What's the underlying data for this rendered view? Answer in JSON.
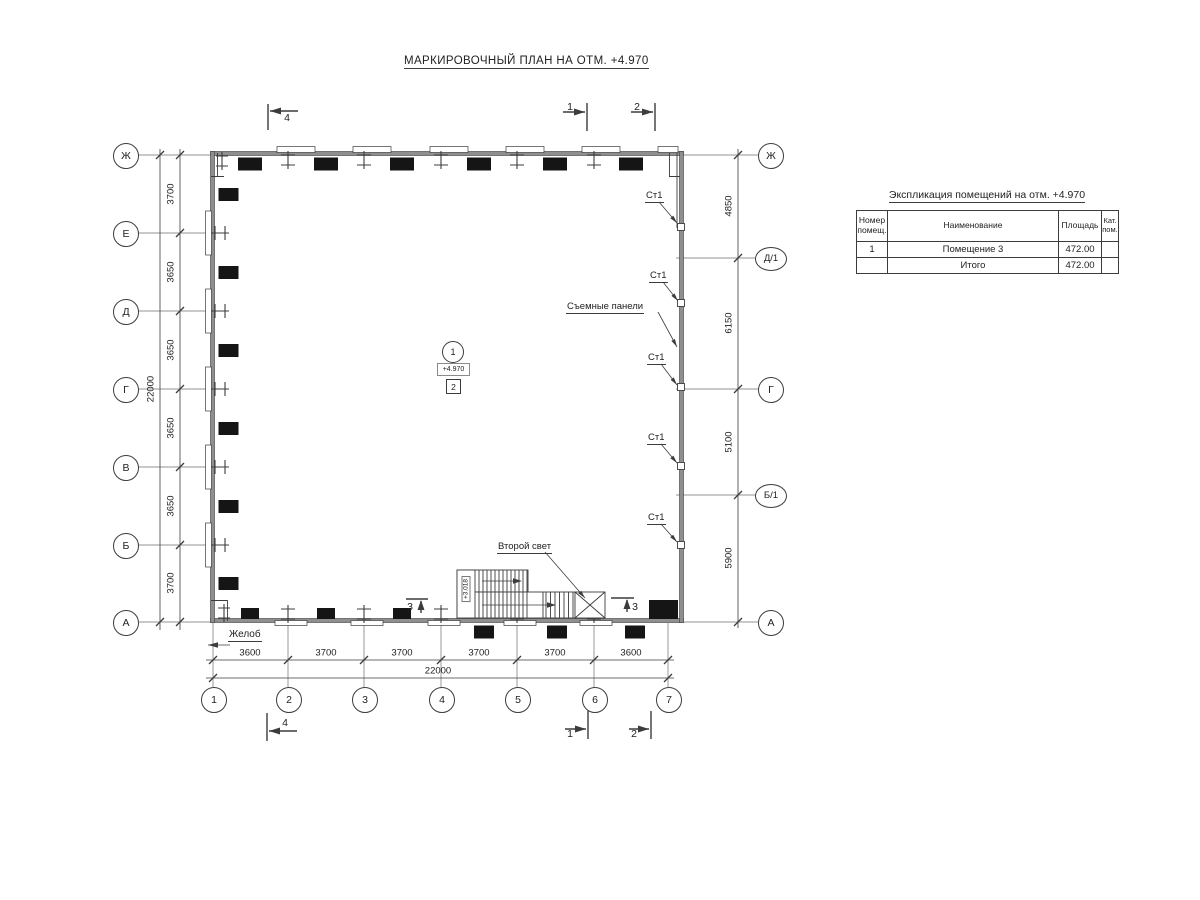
{
  "title": "МАРКИРОВОЧНЫЙ ПЛАН НА ОТМ. +4.970",
  "explication": {
    "title": "Экспликация помещений на отм. +4.970",
    "col_number": "Номер помещ.",
    "col_name": "Наименование",
    "col_area": "Площадь",
    "col_cat": "Кат. пом.",
    "row": {
      "number": "1",
      "name": "Помещение 3",
      "area": "472.00",
      "cat": ""
    },
    "total_label": "Итого",
    "total_area": "472.00"
  },
  "axes": {
    "left": [
      "Ж",
      "Е",
      "Д",
      "Г",
      "В",
      "Б",
      "А"
    ],
    "right": [
      "Ж",
      "Д/1",
      "Г",
      "Б/1",
      "А"
    ],
    "bottom": [
      "1",
      "2",
      "3",
      "4",
      "5",
      "6",
      "7"
    ]
  },
  "dims": {
    "left": [
      "3700",
      "3650",
      "3650",
      "3650",
      "3650",
      "3700"
    ],
    "left_total": "22000",
    "right": [
      "4850",
      "6150",
      "5100",
      "5900"
    ],
    "bottom": [
      "3600",
      "3700",
      "3700",
      "3700",
      "3700",
      "3600"
    ],
    "bottom_total": "22000"
  },
  "sections": {
    "top": [
      "4",
      "1",
      "2"
    ],
    "bottom": [
      "4",
      "1",
      "2"
    ],
    "side": [
      "3",
      "3"
    ]
  },
  "annotations": {
    "st1": "Ст1",
    "removable_panels": "Съемные панели",
    "second_light": "Второй свет",
    "gutter": "Желоб",
    "stair_elevation": "+3.018"
  },
  "room_marker": {
    "number": "1",
    "elevation": "+4.970",
    "type": "2"
  },
  "colors": {
    "line": "#3c3c3c",
    "wall_fill": "#8f8f8f",
    "marker": "#151515"
  }
}
